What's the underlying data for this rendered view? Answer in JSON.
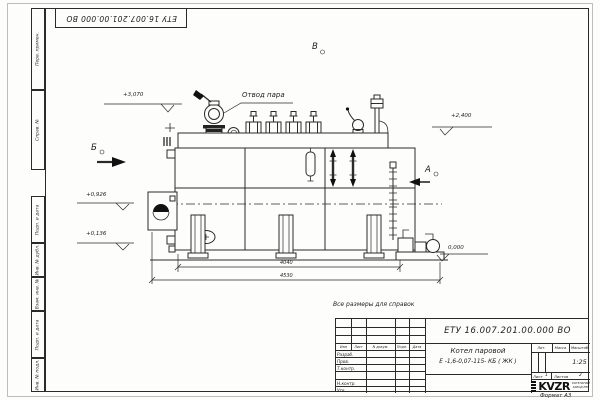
{
  "colors": {
    "ink": "#2a2a2a",
    "paper": "#fdfdfc"
  },
  "sheet": {
    "inverted_stamp": "ЕТУ 16.007.201.00.000  ВО",
    "reference_note": "Все размеры для справок",
    "format_note": "Формат А3"
  },
  "margin_cells": [
    "Перв. примен.",
    "Справ. №",
    "Подп. и дата",
    "Инв. № дубл.",
    "Взам. инв. №",
    "Подп. и дата",
    "Инв. № подл."
  ],
  "drawing": {
    "steam_outlet_label": "Отвод пара",
    "view_labels": {
      "b": "Б",
      "v": "В",
      "a": "А"
    },
    "elevations": [
      "+3,070",
      "+0,926",
      "+0,136",
      "+2,400",
      "0,000"
    ],
    "dimensions": {
      "body_length": "4040",
      "overall_length": "4530"
    }
  },
  "title_block": {
    "doc_number": "ЕТУ 16.007.201.00.000  ВО",
    "product_name": "Котел паровой",
    "product_type": "Е -1,6-0,07-115- КБ ( ЖК )",
    "rev_cols": [
      "Изм",
      "Лист",
      "N докум.",
      "Подп.",
      "Дата"
    ],
    "sign_rows": [
      "Разраб.",
      "Пров.",
      "Т.контр.",
      "Н.контр.",
      "Утв."
    ],
    "lit_label": "Лит.",
    "mass_label": "Масса",
    "scale_label": "Масштаб",
    "scale_value": "1:25",
    "sheet_label": "Лист",
    "sheet_value": "1",
    "sheets_label": "Листов",
    "sheets_value": "2",
    "logo_text": "KVZR",
    "company_line1": "КОТЕЛЬНЫЙ",
    "company_line2": "ЗАВОД РЭП"
  }
}
